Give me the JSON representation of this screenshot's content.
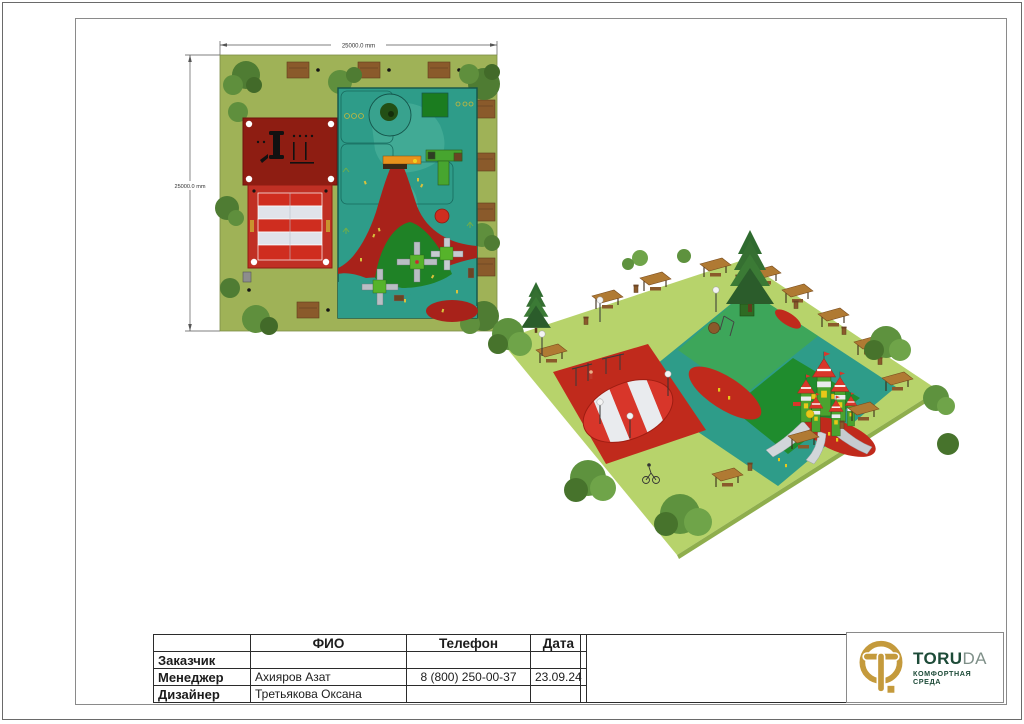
{
  "plan_view": {
    "width_dimension": "25000.0 mm",
    "height_dimension": "25000.0 mm"
  },
  "palette": {
    "lawn_green_plan": "#9fb257",
    "lawn_green_3d": "#b7d36b",
    "rubber_teal": "#2e9c89",
    "rubber_red": "#a8221a",
    "bright_red": "#cf2d1f",
    "dark_red_zone": "#8e1d12",
    "dark_green": "#1f8226",
    "canopy_stripe_light": "#e6e9ee",
    "wood_brown": "#8a5a2b",
    "logo_gold": "#c49a3c",
    "logo_green": "#1d4b38"
  },
  "title_block": {
    "headers": {
      "fio": "ФИО",
      "phone": "Телефон",
      "date": "Дата"
    },
    "rows": [
      {
        "role": "Заказчик",
        "fio": "",
        "phone": "",
        "date": ""
      },
      {
        "role": "Менеджер",
        "fio": "Ахияров Азат",
        "phone": "8 (800) 250-00-37",
        "date": "23.09.24"
      },
      {
        "role": "Дизайнер",
        "fio": "Третьякова Оксана",
        "phone": "",
        "date": ""
      }
    ]
  },
  "logo": {
    "brand_bold": "TORU",
    "brand_light": "DA",
    "tagline_line1": "КОМФОРТНАЯ",
    "tagline_line2": "СРЕДА"
  }
}
